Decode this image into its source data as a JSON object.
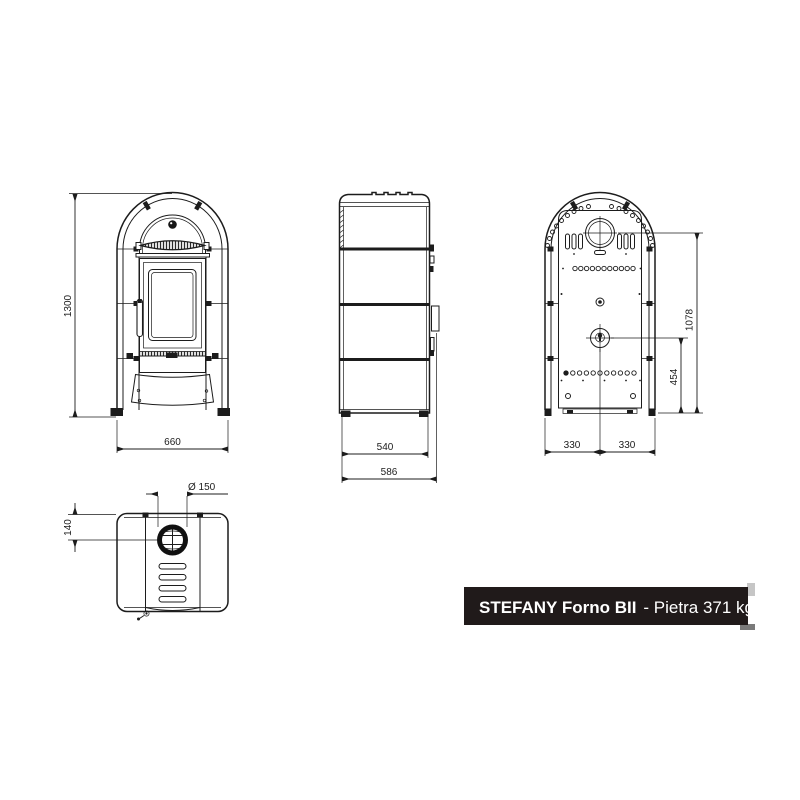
{
  "product_label": {
    "name": "STEFANY Forno BII",
    "variant": "- Pietra 371 kg"
  },
  "dimensions": {
    "overall_height": "1300",
    "overall_width": "660",
    "body_depth": "540",
    "total_depth": "586",
    "flue_center_height": "1078",
    "rear_outlet_height": "454",
    "rear_left_half_width": "330",
    "rear_right_half_width": "330",
    "flue_diameter": "Ø 150",
    "top_flue_offset": "140"
  },
  "colors": {
    "line": "#1c1c1c",
    "label_background": "#201a1a",
    "label_text": "#ffffff",
    "shadow_light": "#c6c6c6",
    "shadow_dark": "#7a7a7a"
  }
}
